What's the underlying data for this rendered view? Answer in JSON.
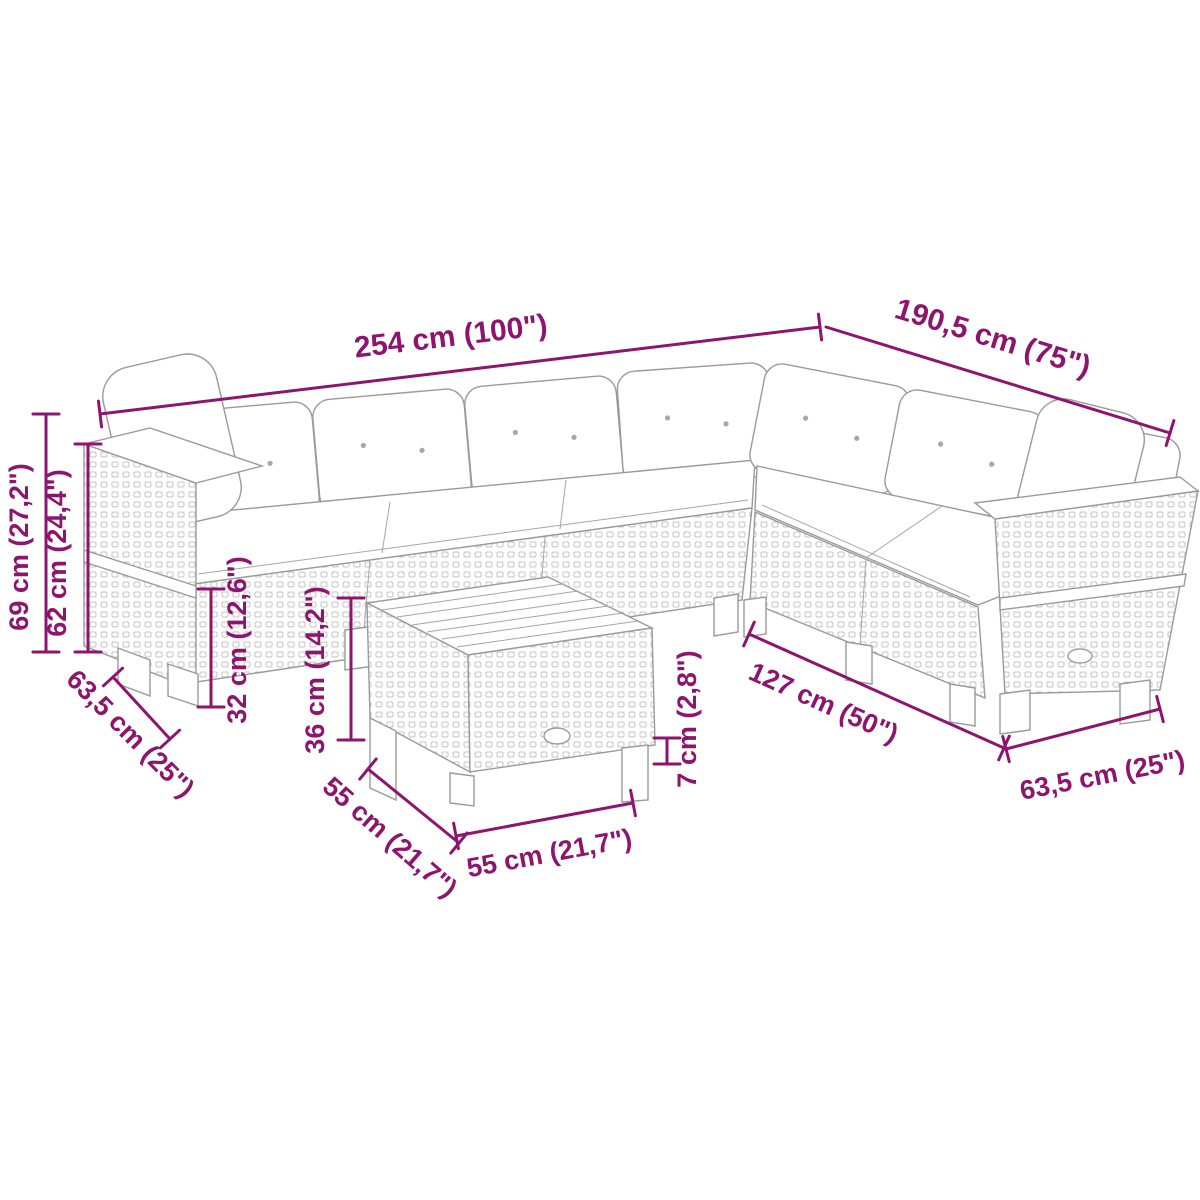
{
  "colors": {
    "dimension_accent": "#8e156e",
    "furniture_outline": "#9a9a9a",
    "background": "#ffffff"
  },
  "dims": {
    "overall_width": "254 cm (100\")",
    "overall_depth": "190,5 cm (75\")",
    "total_height": "69 cm (27,2\")",
    "armrest_height": "62 cm (24,4\")",
    "seat_height": "32 cm (12,6\")",
    "table_height": "36 cm (14,2\")",
    "module_depth_left": "63,5 cm (25\")",
    "table_depth": "55 cm (21,7\")",
    "table_width": "55 cm (21,7\")",
    "cushion_thickness": "7 cm (2,8\")",
    "right_section_length": "127 cm (50\")",
    "module_depth_right": "63,5 cm (25\")"
  }
}
